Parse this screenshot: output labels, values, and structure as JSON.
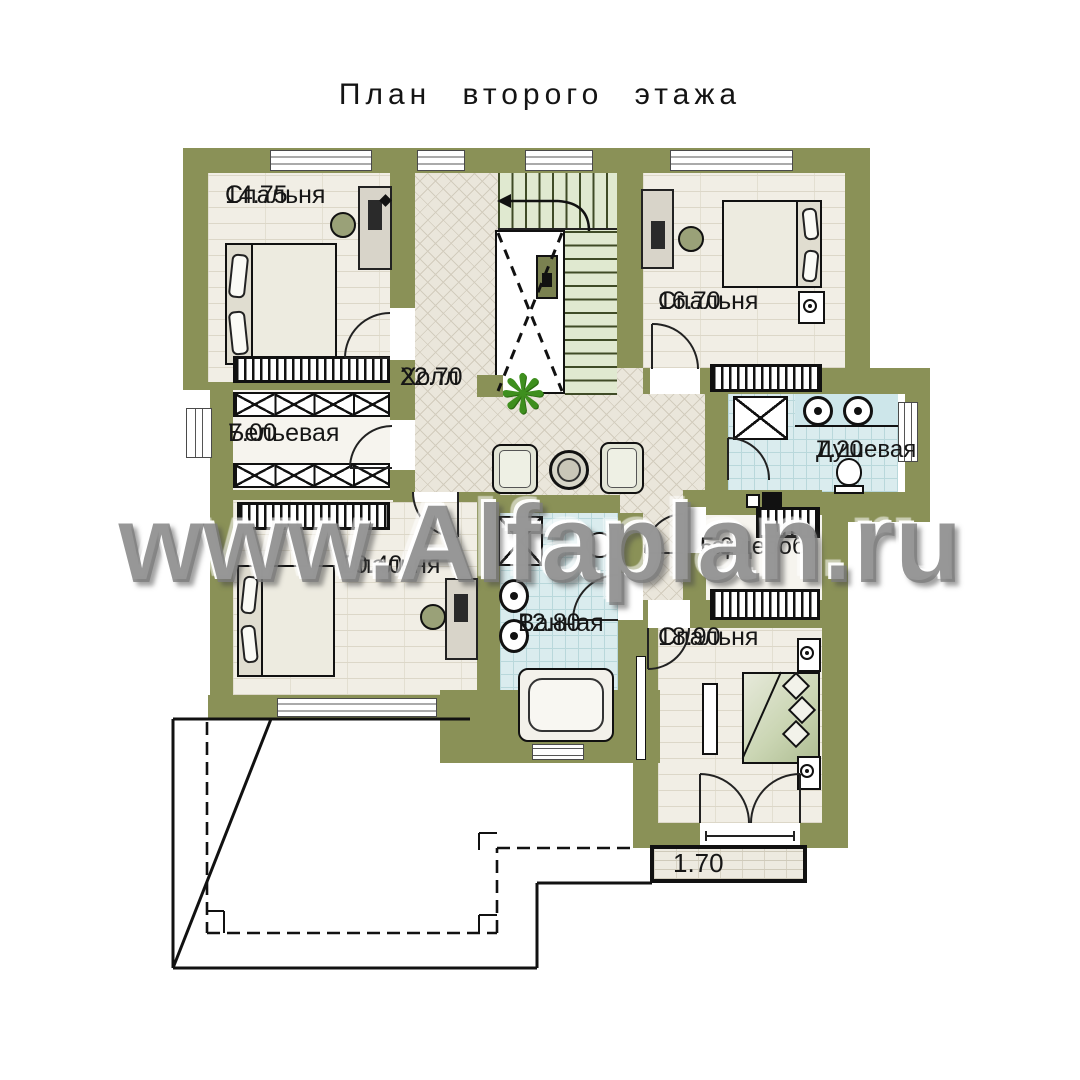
{
  "title": "План второго этажа",
  "watermark": "www.Alfaplan.ru",
  "plant_glyph": "❋",
  "rooms": {
    "bedroom_tl": {
      "name": "Спальня",
      "area": "14.75"
    },
    "bedroom_tr": {
      "name": "Спальня",
      "area": "16.70"
    },
    "hall": {
      "name": "Холл",
      "area": "22.70"
    },
    "linen": {
      "name": "Бельевая",
      "area": "7.00"
    },
    "shower": {
      "name": "Душевая",
      "area": "7.20"
    },
    "bedroom_l": {
      "name": "Спальня",
      "area": "20.40"
    },
    "bath": {
      "name": "Ванная",
      "area": "12.80"
    },
    "wardrobe": {
      "name": "Гардероб",
      "area": "5.00"
    },
    "bedroom_br": {
      "name": "Спальня",
      "area": "18.90"
    },
    "balcony": {
      "area": "1.70"
    }
  },
  "colors": {
    "wall": "#8a9157",
    "floor": "#f1eee5",
    "hall": "#eae6db",
    "tile": "#daecee",
    "stair": "#e0e9d0",
    "plant": "#3e8f1e"
  }
}
